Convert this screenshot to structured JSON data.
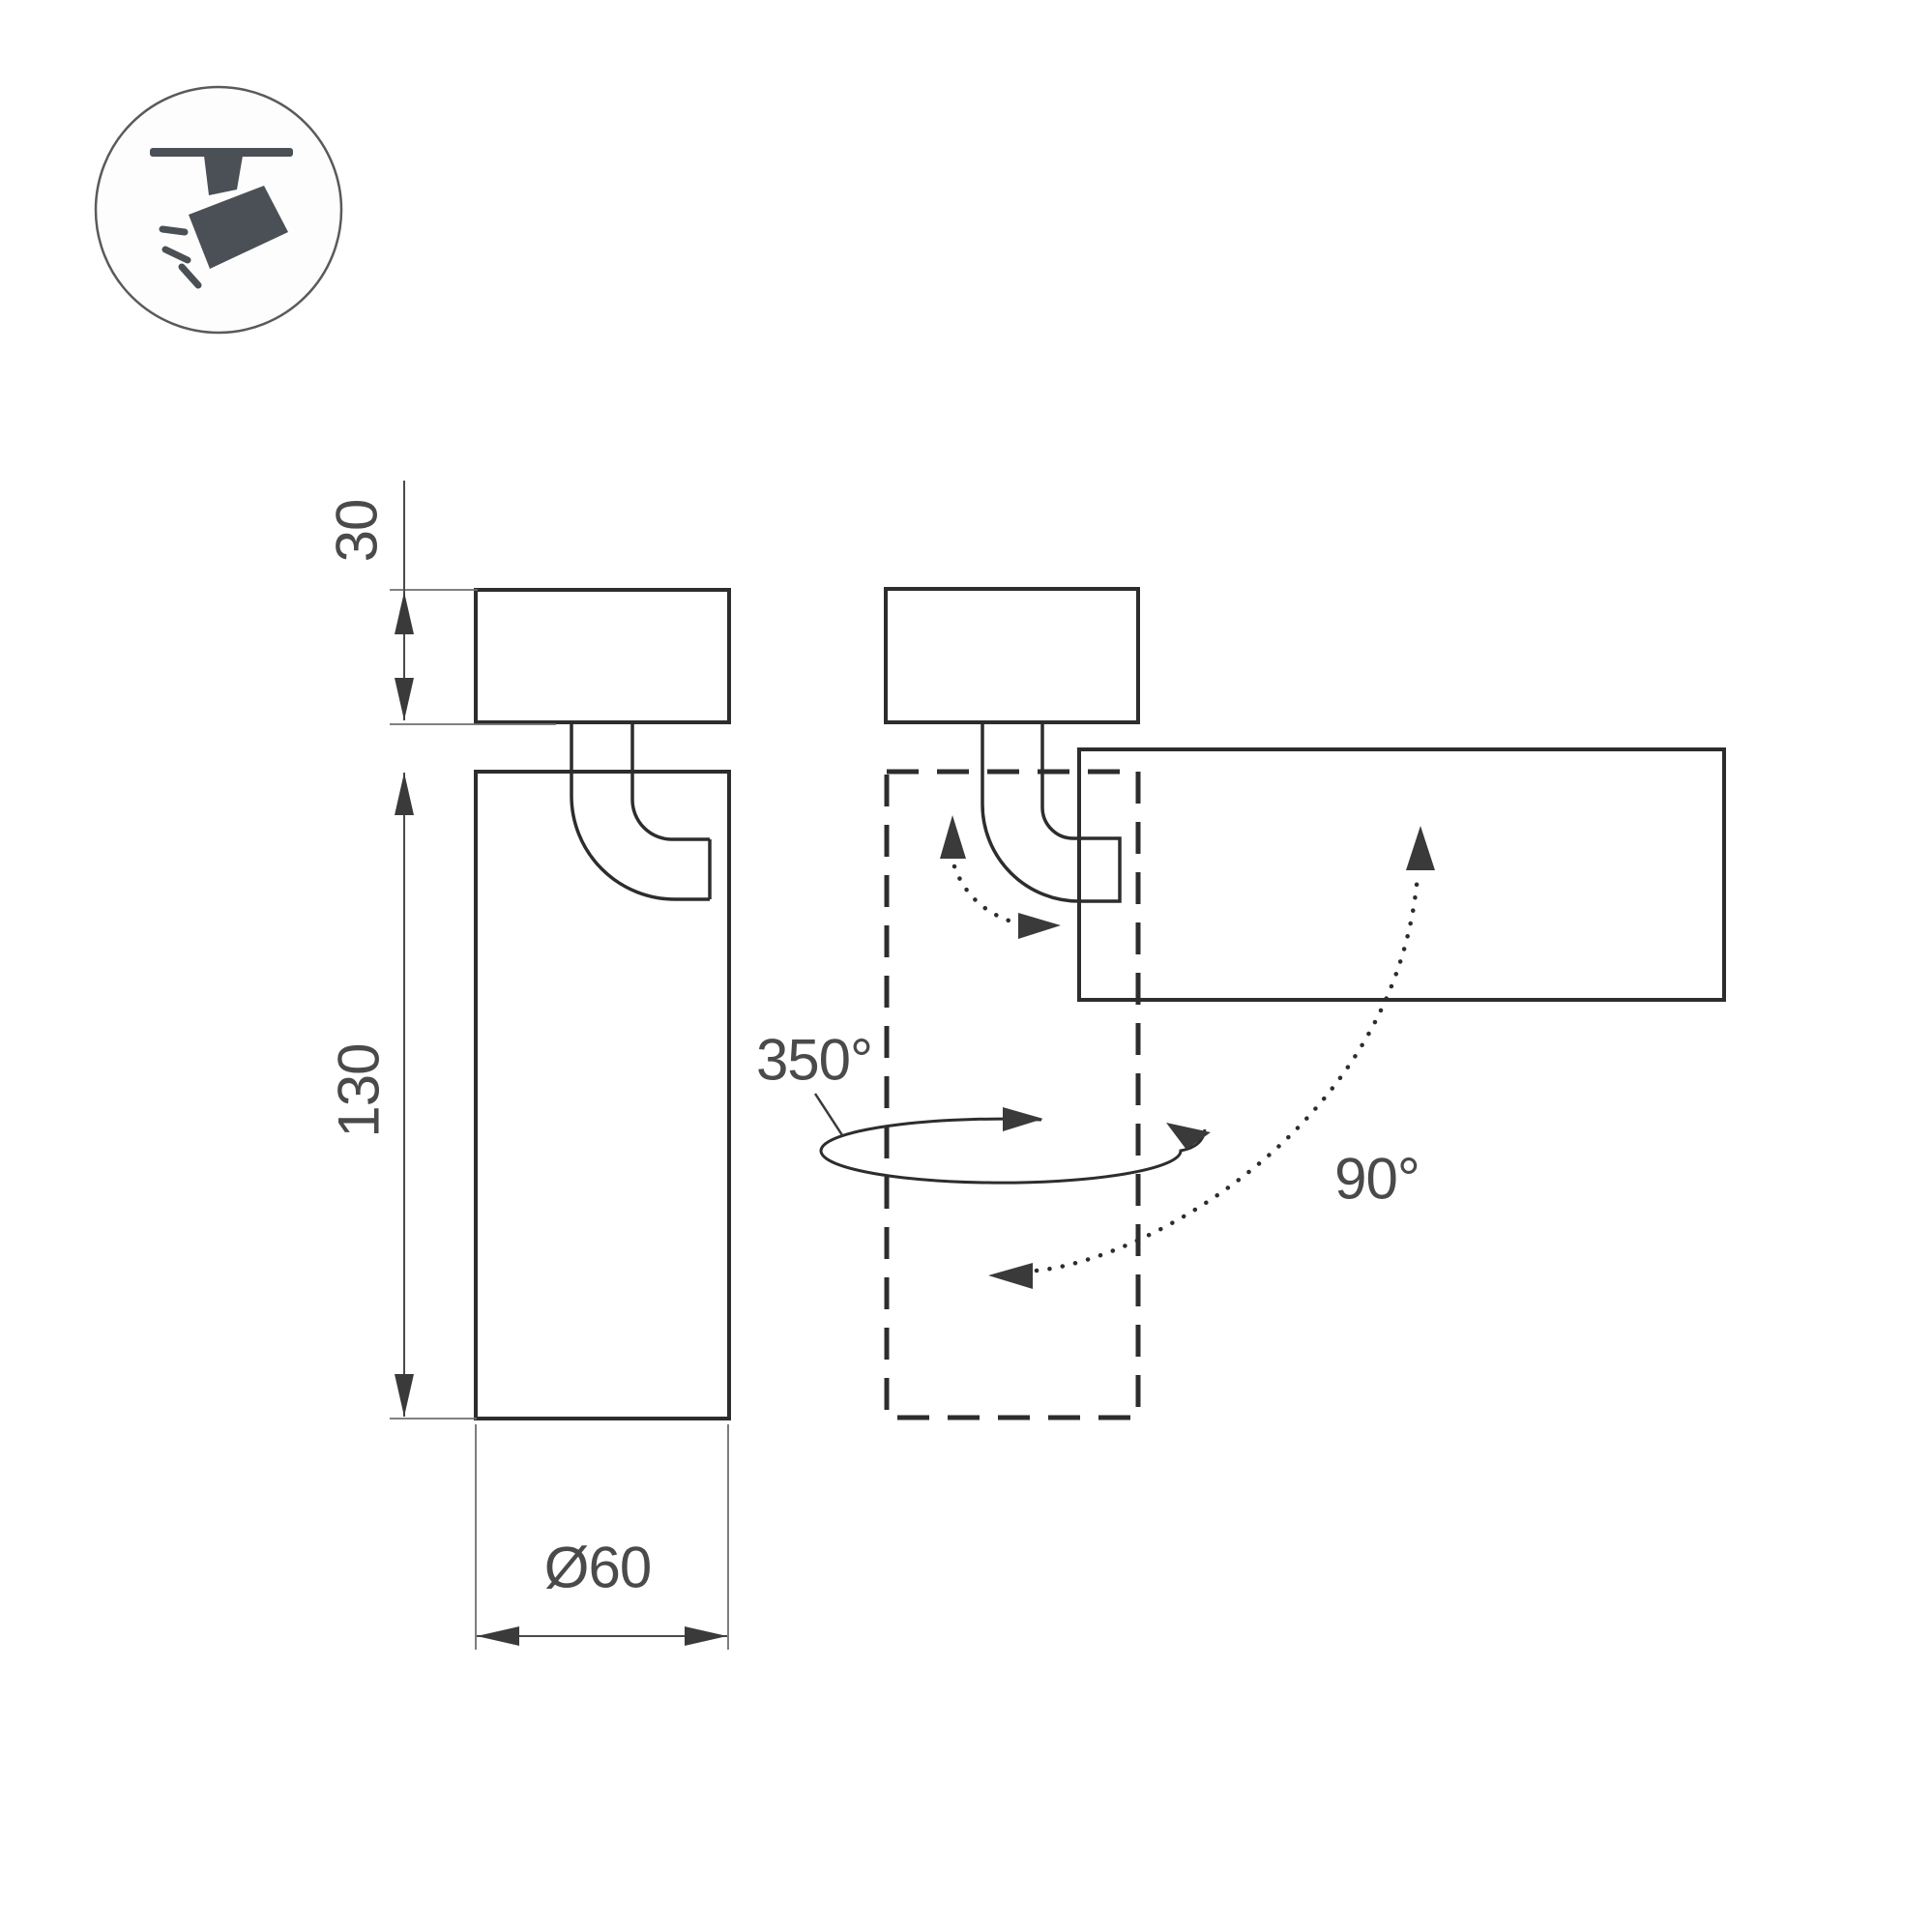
{
  "title": "spot-luminaire-dimension-drawing",
  "badge": {
    "icon": "track-spotlight-icon"
  },
  "dimensions": {
    "canopy_height": {
      "label": "30"
    },
    "body_length": {
      "label": "130"
    },
    "body_diameter": {
      "label": "Ø60"
    }
  },
  "rotation": {
    "pan_angle": {
      "label": "350°"
    },
    "tilt_angle": {
      "label": "90°"
    }
  },
  "colors": {
    "background": "#ffffff",
    "outline": "#2d2d2d",
    "thin_line": "#6f6f6f",
    "text": "#4a4a4a",
    "arrow": "#3a3a3a",
    "icon": "#4a5055"
  }
}
